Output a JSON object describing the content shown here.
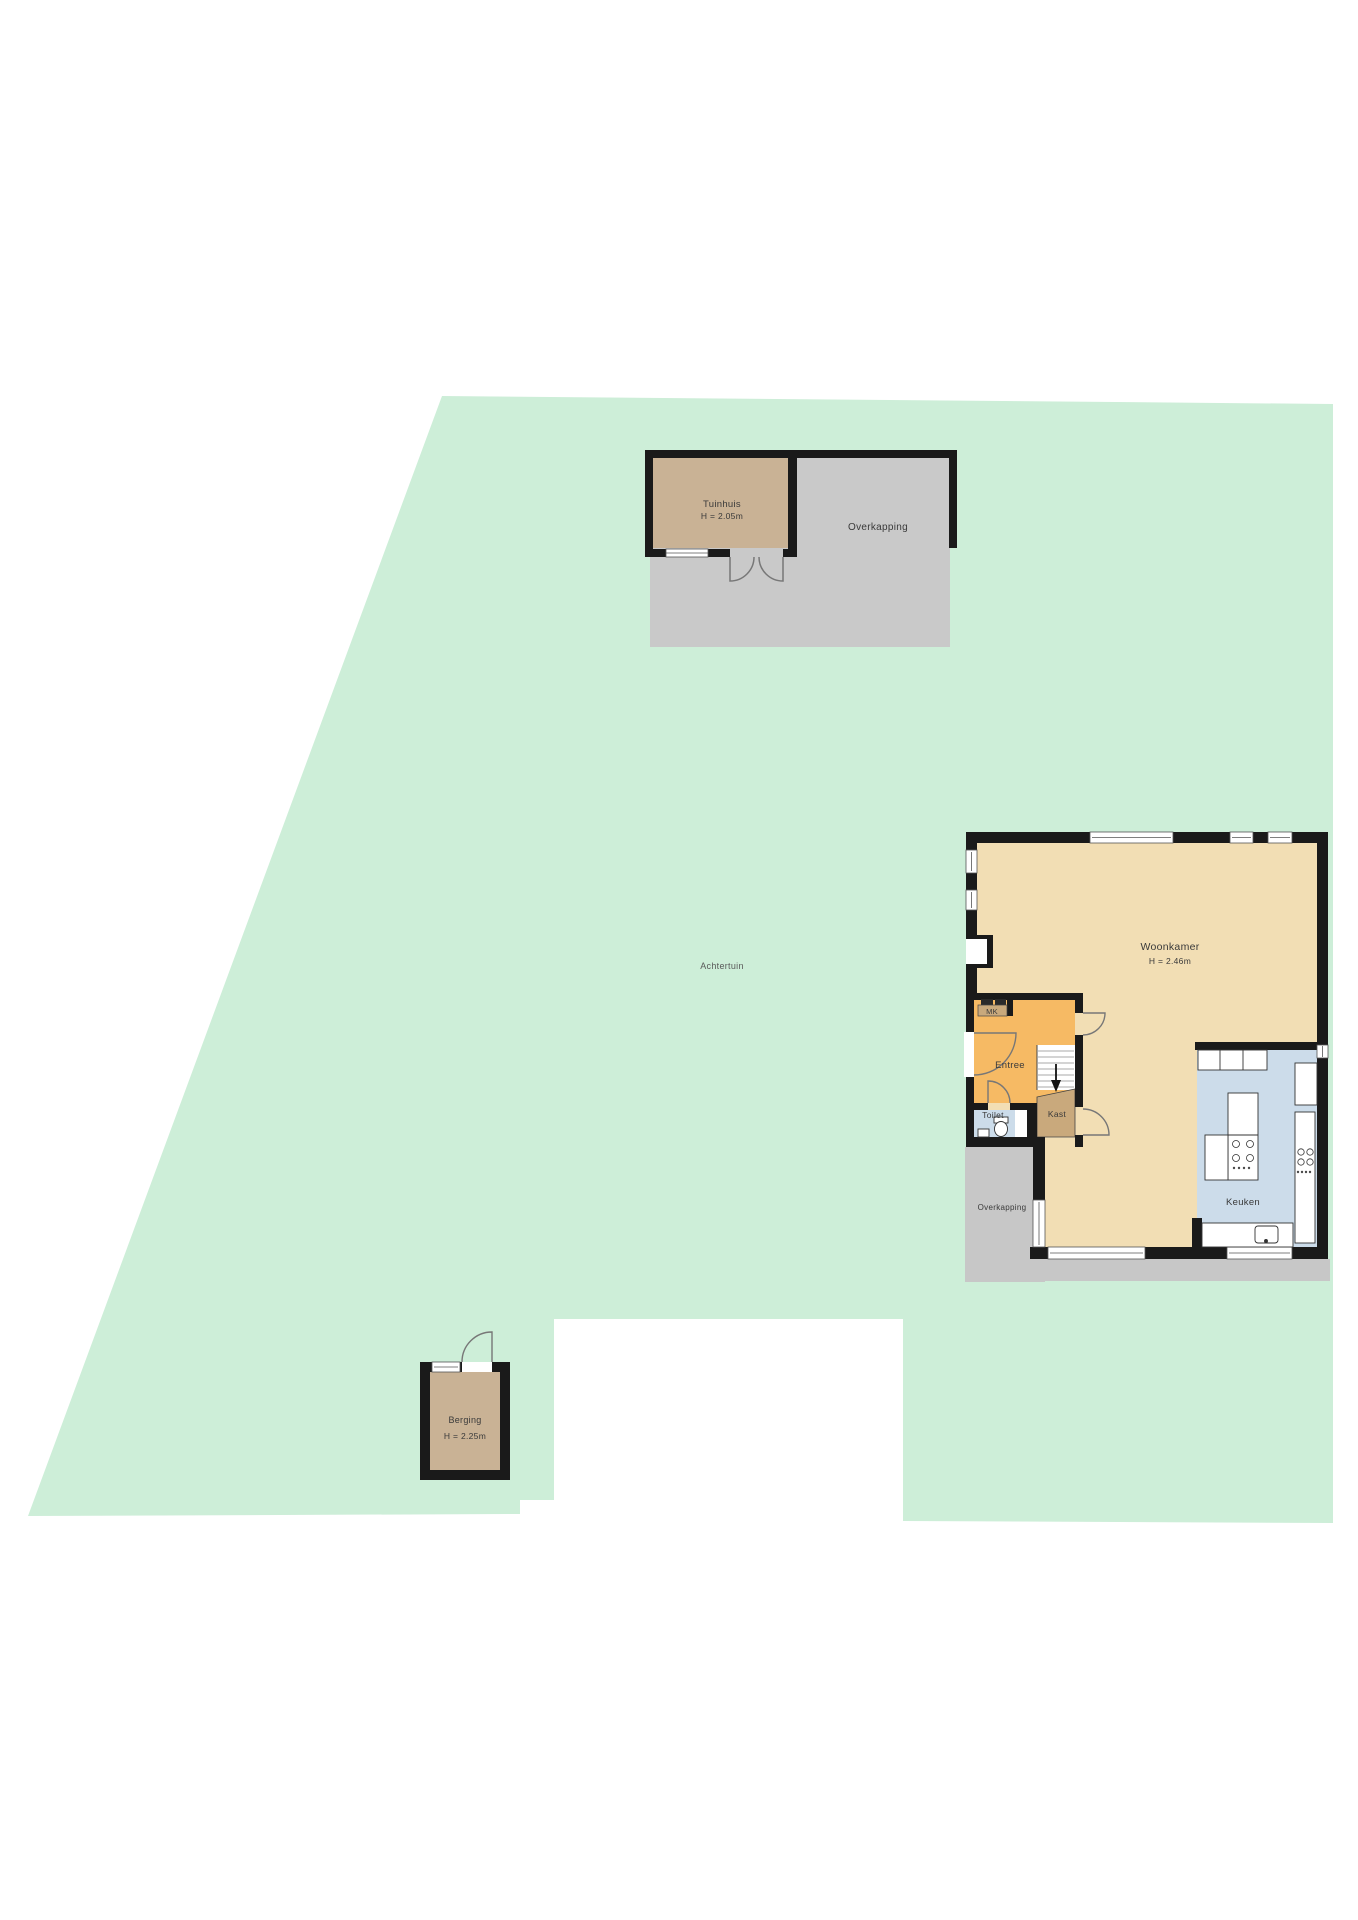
{
  "labels": {
    "garden": "Achtertuin",
    "tuinhuis": "Tuinhuis",
    "tuinhuis_height": "H = 2.05m",
    "overkapping_garden": "Overkapping",
    "woonkamer": "Woonkamer",
    "woonkamer_height": "H = 2.46m",
    "entree": "Entree",
    "mk": "MK",
    "toilet": "Toilet",
    "kast": "Kast",
    "keuken": "Keuken",
    "overkapping_house": "Overkapping",
    "berging": "Berging",
    "berging_height": "H = 2.25m"
  },
  "colors": {
    "garden_green": "#cdeed8",
    "wall_black": "#1a1a1a",
    "living_beige": "#f2deb4",
    "entree_orange": "#f6ba64",
    "kast_tan": "#c9a97c",
    "wet_room_blue": "#ccdcea",
    "shed_brown": "#c9b295",
    "canopy_gray": "#c9c9c9",
    "label_gray": "#3a3a3a"
  }
}
